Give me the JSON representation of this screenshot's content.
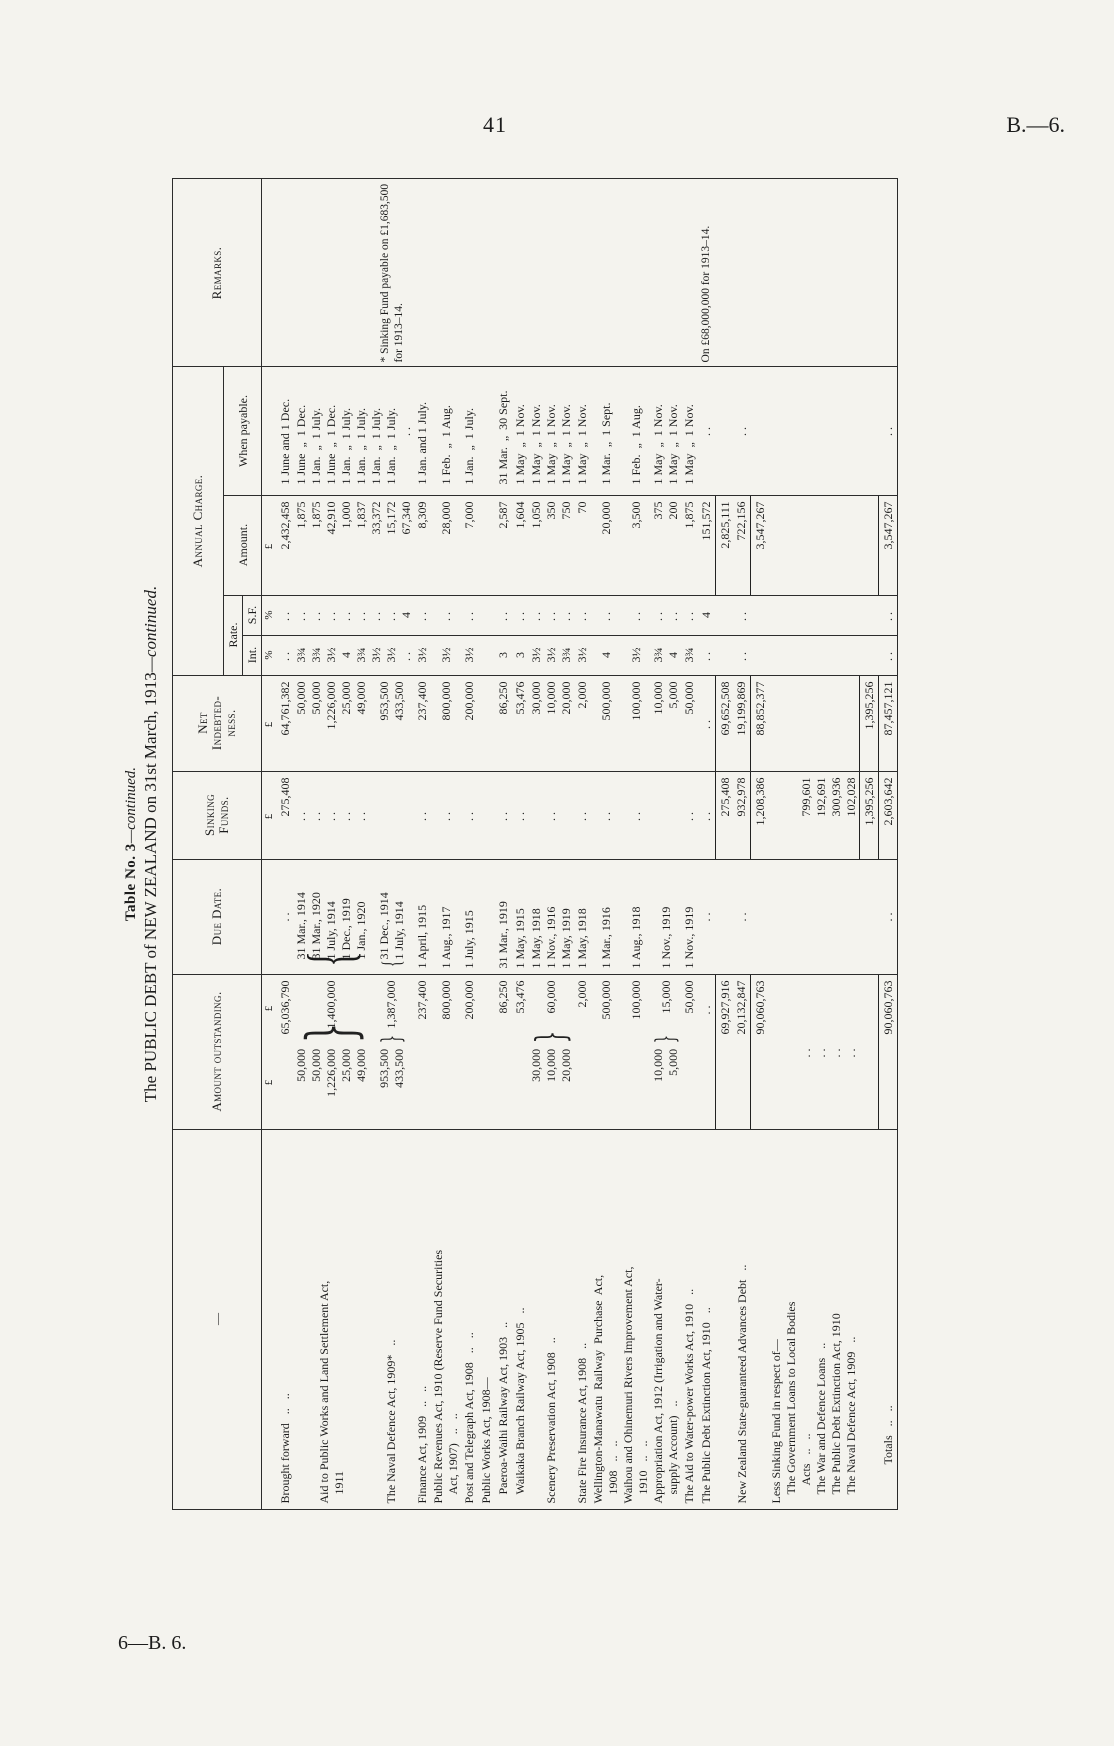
{
  "page": {
    "page_number": "41",
    "doc_ref": "B.—6.",
    "footer_ref": "6—B. 6."
  },
  "title": {
    "line1_main": "Table No. 3",
    "line1_cont": "—continued.",
    "line2_main": "The PUBLIC DEBT of NEW ZEALAND on 31st March, 1913",
    "line2_cont": "—continued."
  },
  "table": {
    "headers": {
      "stub": "—",
      "amount_outstanding": "Amount outstanding.",
      "due_date": "Due Date.",
      "sinking_funds": "Sinking\nFunds.",
      "net_indebtedness": "Net\nIndebted-\nness.",
      "annual_charge": "Annual Charge.",
      "rate": "Rate.",
      "int": "Int.",
      "sf": "S.F.",
      "amount": "Amount.",
      "when_payable": "When payable.",
      "remarks": "Remarks."
    },
    "rows": [
      {
        "sym": true,
        "amount": {
          "items": [
            "£"
          ],
          "total": "£"
        },
        "sink": [
          "£"
        ],
        "net": [
          "£"
        ],
        "int": [
          "%"
        ],
        "sf": [
          "%"
        ],
        "annual": [
          "£"
        ]
      },
      {
        "label": "Brought forward   ..   ..",
        "amount": {
          "total": "65,036,790"
        },
        "due": [
          ".."
        ],
        "sink": [
          "275,408"
        ],
        "net": [
          "64,761,382"
        ],
        "int": [
          ".."
        ],
        "sf": [
          ".."
        ],
        "annual": [
          "2,432,458"
        ],
        "when": [
          "1 June and 1 Dec."
        ]
      },
      {
        "label": [
          "Aid to Public Works and Land Settlement Act,",
          "   1911"
        ],
        "amount": {
          "items": [
            "50,000",
            "50,000",
            "1,226,000",
            "25,000",
            "49,000"
          ],
          "brace": true,
          "total": "1,400,000"
        },
        "due": [
          "31 Mar., 1914",
          "31 Mar., 1920",
          "1 July, 1914",
          "1 Dec., 1919",
          "1 Jan., 1920"
        ],
        "due_brace": true,
        "sink": [
          "..",
          "..",
          "..",
          "..",
          ".."
        ],
        "net": [
          "50,000",
          "50,000",
          "1,226,000",
          "25,000",
          "49,000"
        ],
        "int": [
          "3¾",
          "3¾",
          "3½",
          "4",
          "3¾"
        ],
        "sf": [
          "..",
          "..",
          "..",
          "..",
          ".."
        ],
        "annual": [
          "1,875",
          "1,875",
          "42,910",
          "1,000",
          "1,837"
        ],
        "when": [
          "1 June  „  1 Dec.",
          "1 Jan.  „  1 July.",
          "1 June  „  1 Dec.",
          "1 Jan.  „  1 July.",
          "1 Jan.  „  1 July."
        ]
      },
      {
        "label": "The Naval Defence Act, 1909*   ..",
        "amount": {
          "items": [
            "953,500",
            "433,500"
          ],
          "brace": true,
          "total": "1,387,000"
        },
        "due": [
          "31 Dec., 1914",
          "1 July, 1914"
        ],
        "due_brace": true,
        "net": [
          "953,500",
          "433,500"
        ],
        "int": [
          "3½",
          "3½",
          ".."
        ],
        "sf": [
          "..",
          "..",
          "4"
        ],
        "annual": [
          "33,372",
          "15,172",
          "67,340"
        ],
        "when": [
          "1 Jan.  „  1 July.",
          "1 Jan.  „  1 July.",
          ".."
        ],
        "remarks": "* Sinking Fund payable on £1,683,500 for 1913–14."
      },
      {
        "label": "Finance Act, 1909   ..   ..",
        "amount": {
          "total": "237,400"
        },
        "due": [
          "1 April, 1915"
        ],
        "sink": [
          ".."
        ],
        "net": [
          "237,400"
        ],
        "int": [
          "3½"
        ],
        "sf": [
          ".."
        ],
        "annual": [
          "8,309"
        ],
        "when": [
          "1 Jan. and 1 July."
        ]
      },
      {
        "label": [
          "Public Revenues Act, 1910 (Reserve Fund Securities",
          "   Act, 1907)   ..   .."
        ],
        "amount": {
          "total": "800,000"
        },
        "due": [
          "1 Aug., 1917"
        ],
        "sink": [
          ".."
        ],
        "net": [
          "800,000"
        ],
        "int": [
          "3½"
        ],
        "sf": [
          ".."
        ],
        "annual": [
          "28,000"
        ],
        "when": [
          "1 Feb.  „  1 Aug."
        ]
      },
      {
        "label": "Post and Telegraph Act, 1908   ..   ..",
        "amount": {
          "total": "200,000"
        },
        "due": [
          "1 July, 1915"
        ],
        "sink": [
          ".."
        ],
        "net": [
          "200,000"
        ],
        "int": [
          "3½"
        ],
        "sf": [
          ".."
        ],
        "annual": [
          "7,000"
        ],
        "when": [
          "1 Jan.  „  1 July."
        ]
      },
      {
        "label": "Public Works Act, 1908—"
      },
      {
        "label": "   Paeroa-Waihi Railway Act, 1903   ..",
        "amount": {
          "total": "86,250"
        },
        "due": [
          "31 Mar., 1919"
        ],
        "sink": [
          ".."
        ],
        "net": [
          "86,250"
        ],
        "int": [
          "3"
        ],
        "sf": [
          ".."
        ],
        "annual": [
          "2,587"
        ],
        "when": [
          "31 Mar.  „  30 Sept."
        ]
      },
      {
        "label": "   Waikaka Branch Railway Act, 1905   ..",
        "amount": {
          "total": "53,476"
        },
        "due": [
          "1 May, 1915"
        ],
        "sink": [
          ".."
        ],
        "net": [
          "53,476"
        ],
        "int": [
          "3"
        ],
        "sf": [
          ".."
        ],
        "annual": [
          "1,604"
        ],
        "when": [
          "1 May  „  1 Nov."
        ]
      },
      {
        "label": "Scenery Preservation Act, 1908   ..",
        "amount": {
          "items": [
            "30,000",
            "10,000",
            "20,000"
          ],
          "brace": true,
          "total": "60,000"
        },
        "due": [
          "1 May, 1918",
          "1 Nov., 1916",
          "1 May, 1919"
        ],
        "sink": [
          ".."
        ],
        "net": [
          "30,000",
          "10,000",
          "20,000"
        ],
        "int": [
          "3½",
          "3½",
          "3¾"
        ],
        "sf": [
          "..",
          "..",
          ".."
        ],
        "annual": [
          "1,050",
          "350",
          "750"
        ],
        "when": [
          "1 May  „  1 Nov.",
          "1 May  „  1 Nov.",
          "1 May  „  1 Nov."
        ]
      },
      {
        "label": "State Fire Insurance Act, 1908   ..",
        "amount": {
          "total": "2,000"
        },
        "due": [
          "1 May, 1918"
        ],
        "sink": [
          ".."
        ],
        "net": [
          "2,000"
        ],
        "int": [
          "3½"
        ],
        "sf": [
          ".."
        ],
        "annual": [
          "70"
        ],
        "when": [
          "1 May  „  1 Nov."
        ]
      },
      {
        "label": [
          "Wellington-Manawatu  Railway  Purchase  Act,",
          "   1908   ..   .."
        ],
        "amount": {
          "total": "500,000"
        },
        "due": [
          "1 Mar., 1916"
        ],
        "sink": [
          ".."
        ],
        "net": [
          "500,000"
        ],
        "int": [
          "4"
        ],
        "sf": [
          ".."
        ],
        "annual": [
          "20,000"
        ],
        "when": [
          "1 Mar.  „  1 Sept."
        ]
      },
      {
        "label": [
          "Waihou and Ohinemuri Rivers Improvement Act,",
          "   1910   ..   .."
        ],
        "amount": {
          "total": "100,000"
        },
        "due": [
          "1 Aug., 1918"
        ],
        "sink": [
          ".."
        ],
        "net": [
          "100,000"
        ],
        "int": [
          "3½"
        ],
        "sf": [
          ".."
        ],
        "annual": [
          "3,500"
        ],
        "when": [
          "1 Feb.  „  1 Aug."
        ]
      },
      {
        "label": [
          "Appropriation Act, 1912 (Irrigation and Water-",
          "   supply Account)   .."
        ],
        "amount": {
          "items": [
            "10,000",
            "5,000"
          ],
          "brace": true,
          "total": "15,000"
        },
        "due": [
          "1 Nov., 1919"
        ],
        "net": [
          "10,000",
          "5,000"
        ],
        "int": [
          "3¾",
          "4"
        ],
        "sf": [
          "..",
          ".."
        ],
        "annual": [
          "375",
          "200"
        ],
        "when": [
          "1 May  „  1 Nov.",
          "1 May  „  1 Nov."
        ]
      },
      {
        "label": "The Aid to Water-power Works Act, 1910   ..",
        "amount": {
          "total": "50,000"
        },
        "due": [
          "1 Nov., 1919"
        ],
        "sink": [
          ".."
        ],
        "net": [
          "50,000"
        ],
        "int": [
          "3¾"
        ],
        "sf": [
          ".."
        ],
        "annual": [
          "1,875"
        ],
        "when": [
          "1 May  „  1 Nov."
        ]
      },
      {
        "label": "The Public Debt Extinction Act, 1910   ..",
        "amount": {
          "total": ".."
        },
        "due": [
          ".."
        ],
        "sink": [
          ".."
        ],
        "net": [
          ".."
        ],
        "int": [
          ".."
        ],
        "sf": [
          "4"
        ],
        "annual": [
          "151,572"
        ],
        "when": [
          ".."
        ],
        "remarks": "On £68,000,000 for 1913–14."
      },
      {
        "gap": true,
        "rules": [
          "amount",
          "sink",
          "net",
          "annual"
        ],
        "amount": {
          "total": "69,927,916"
        },
        "sink": [
          "275,408"
        ],
        "net": [
          "69,652,508"
        ],
        "annual": [
          "2,825,111"
        ]
      },
      {
        "label": "New Zealand State-guaranteed Advances Debt   ..",
        "amount": {
          "total": "20,132,847"
        },
        "due": [
          ".."
        ],
        "sink": [
          "932,978"
        ],
        "net": [
          "19,199,869"
        ],
        "int": [
          ".."
        ],
        "sf": [
          ".."
        ],
        "annual": [
          "722,156"
        ],
        "when": [
          ".."
        ]
      },
      {
        "gap": true,
        "rules": [
          "amount",
          "sink",
          "net",
          "annual"
        ],
        "amount": {
          "total": "90,060,763"
        },
        "sink": [
          "1,208,386"
        ],
        "net": [
          "88,852,377"
        ],
        "annual": [
          "3,547,267"
        ]
      },
      {
        "label": [
          "Less Sinking Fund in respect of—",
          "   The Government Loans to Local Bodies",
          "      Acts   ..   ..",
          "   The War and Defence Loans   ..",
          "   The Public Debt Extinction Act, 1910",
          "   The Naval Defence Act, 1909   .."
        ],
        "amount": {
          "lines": [
            "",
            "",
            "..",
            "..",
            "..",
            ".."
          ]
        },
        "sink": [
          "",
          "",
          "799,601",
          "192,691",
          "300,936",
          "102,028"
        ]
      },
      {
        "gap": true,
        "rules": [
          "sink",
          "net"
        ],
        "sink": [
          "1,395,256"
        ],
        "net": [
          "1,395,256"
        ]
      },
      {
        "gap": true,
        "label": "             Totals   ..   ..",
        "rules": [
          "amount",
          "sink",
          "net",
          "annual"
        ],
        "amount": {
          "total": "90,060,763"
        },
        "due": [
          ".."
        ],
        "sink": [
          "2,603,642"
        ],
        "net": [
          "87,457,121"
        ],
        "int": [
          ".."
        ],
        "sf": [
          ".."
        ],
        "annual": [
          "3,547,267"
        ],
        "when": [
          ".."
        ]
      }
    ]
  }
}
